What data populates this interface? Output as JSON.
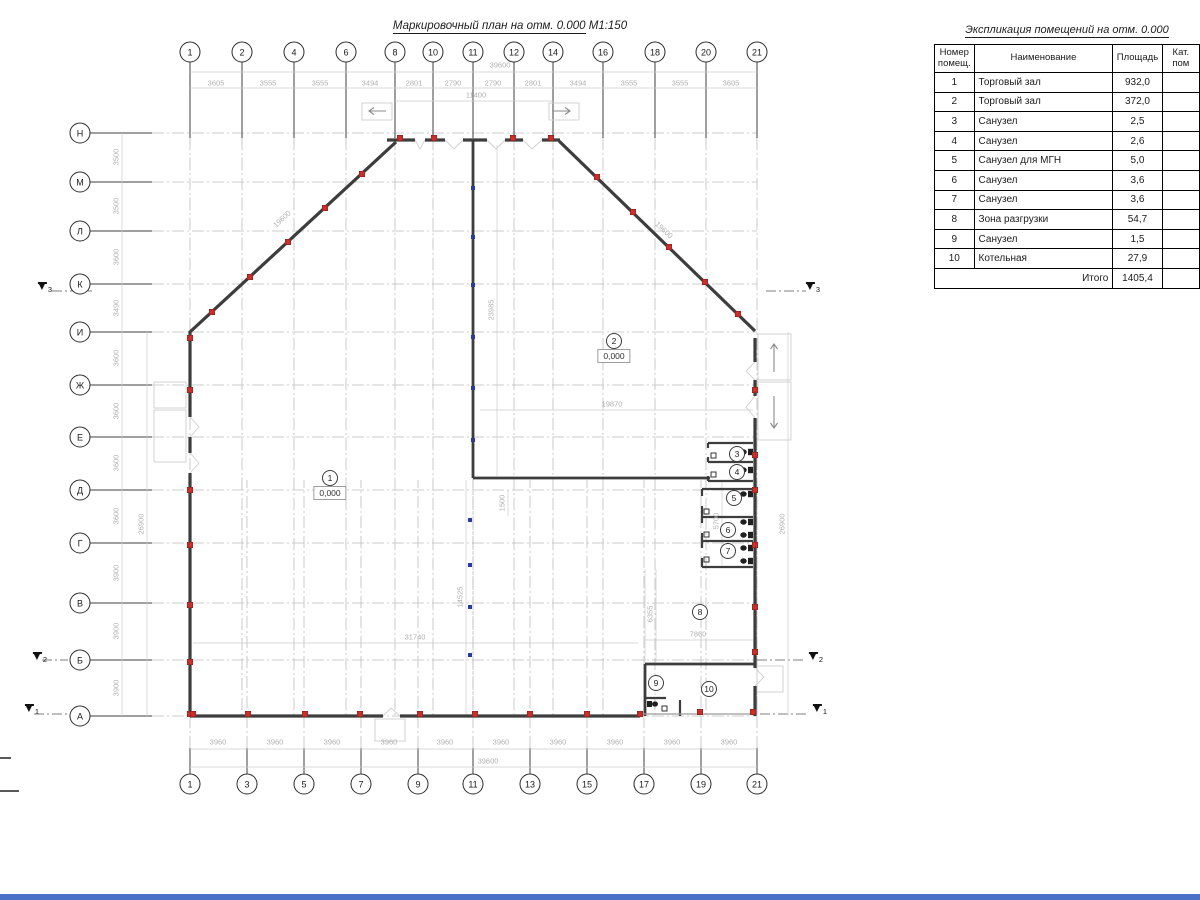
{
  "drawing_title": {
    "text": "Маркировочный план на отм. 0.000",
    "scale": "М1:150"
  },
  "table": {
    "title": "Экспликация помещений на отм. 0.000",
    "headers": {
      "num": "Номер помещ.",
      "name": "Наименование",
      "area": "Площадь",
      "cat": "Кат. пом"
    },
    "rows": [
      {
        "num": "1",
        "name": "Торговый зал",
        "area": "932,0"
      },
      {
        "num": "2",
        "name": "Торговый зал",
        "area": "372,0"
      },
      {
        "num": "3",
        "name": "Санузел",
        "area": "2,5"
      },
      {
        "num": "4",
        "name": "Санузел",
        "area": "2,6"
      },
      {
        "num": "5",
        "name": "Санузел для МГН",
        "area": "5,0"
      },
      {
        "num": "6",
        "name": "Санузел",
        "area": "3,6"
      },
      {
        "num": "7",
        "name": "Санузел",
        "area": "3,6"
      },
      {
        "num": "8",
        "name": "Зона разгрузки",
        "area": "54,7"
      },
      {
        "num": "9",
        "name": "Санузел",
        "area": "1,5"
      },
      {
        "num": "10",
        "name": "Котельная",
        "area": "27,9"
      }
    ],
    "total_label": "Итого",
    "total_value": "1405,4"
  },
  "axes": {
    "top": [
      {
        "label": "1",
        "x": 190
      },
      {
        "label": "2",
        "x": 242
      },
      {
        "label": "4",
        "x": 294
      },
      {
        "label": "6",
        "x": 346
      },
      {
        "label": "8",
        "x": 395
      },
      {
        "label": "10",
        "x": 433
      },
      {
        "label": "11",
        "x": 473
      },
      {
        "label": "12",
        "x": 514
      },
      {
        "label": "14",
        "x": 553
      },
      {
        "label": "16",
        "x": 603
      },
      {
        "label": "18",
        "x": 655
      },
      {
        "label": "20",
        "x": 706
      },
      {
        "label": "21",
        "x": 757
      }
    ],
    "bottom": [
      {
        "label": "1",
        "x": 190
      },
      {
        "label": "3",
        "x": 247
      },
      {
        "label": "5",
        "x": 304
      },
      {
        "label": "7",
        "x": 361
      },
      {
        "label": "9",
        "x": 418
      },
      {
        "label": "11",
        "x": 473
      },
      {
        "label": "13",
        "x": 530
      },
      {
        "label": "15",
        "x": 587
      },
      {
        "label": "17",
        "x": 644
      },
      {
        "label": "19",
        "x": 701
      },
      {
        "label": "21",
        "x": 757
      }
    ],
    "left": [
      {
        "label": "Н",
        "y": 133
      },
      {
        "label": "М",
        "y": 182
      },
      {
        "label": "Л",
        "y": 231
      },
      {
        "label": "К",
        "y": 284
      },
      {
        "label": "И",
        "y": 332
      },
      {
        "label": "Ж",
        "y": 385
      },
      {
        "label": "Е",
        "y": 437
      },
      {
        "label": "Д",
        "y": 490
      },
      {
        "label": "Г",
        "y": 543
      },
      {
        "label": "В",
        "y": 603
      },
      {
        "label": "Б",
        "y": 660
      },
      {
        "label": "А",
        "y": 716
      }
    ]
  },
  "dim_labels": [
    {
      "t": "3605",
      "x": 216,
      "y": 83
    },
    {
      "t": "3555",
      "x": 268,
      "y": 83
    },
    {
      "t": "3555",
      "x": 320,
      "y": 83
    },
    {
      "t": "3494",
      "x": 370,
      "y": 83
    },
    {
      "t": "2801",
      "x": 414,
      "y": 83
    },
    {
      "t": "2790",
      "x": 453,
      "y": 83
    },
    {
      "t": "2790",
      "x": 493,
      "y": 83
    },
    {
      "t": "2801",
      "x": 533,
      "y": 83
    },
    {
      "t": "3494",
      "x": 578,
      "y": 83
    },
    {
      "t": "3555",
      "x": 629,
      "y": 83
    },
    {
      "t": "3555",
      "x": 680,
      "y": 83
    },
    {
      "t": "3605",
      "x": 731,
      "y": 83
    },
    {
      "t": "39600",
      "x": 500,
      "y": 65
    },
    {
      "t": "11400",
      "x": 476,
      "y": 95
    },
    {
      "t": "3960",
      "x": 218,
      "y": 742
    },
    {
      "t": "3960",
      "x": 275,
      "y": 742
    },
    {
      "t": "3960",
      "x": 332,
      "y": 742
    },
    {
      "t": "3960",
      "x": 389,
      "y": 742
    },
    {
      "t": "3960",
      "x": 445,
      "y": 742
    },
    {
      "t": "3960",
      "x": 501,
      "y": 742
    },
    {
      "t": "3960",
      "x": 558,
      "y": 742
    },
    {
      "t": "3960",
      "x": 615,
      "y": 742
    },
    {
      "t": "3960",
      "x": 672,
      "y": 742
    },
    {
      "t": "3960",
      "x": 729,
      "y": 742
    },
    {
      "t": "39600",
      "x": 488,
      "y": 761
    },
    {
      "t": "3500",
      "x": 116,
      "y": 157,
      "r": -90
    },
    {
      "t": "3500",
      "x": 116,
      "y": 206,
      "r": -90
    },
    {
      "t": "3600",
      "x": 116,
      "y": 257,
      "r": -90
    },
    {
      "t": "3490",
      "x": 116,
      "y": 308,
      "r": -90
    },
    {
      "t": "3600",
      "x": 116,
      "y": 358,
      "r": -90
    },
    {
      "t": "3600",
      "x": 116,
      "y": 411,
      "r": -90
    },
    {
      "t": "3600",
      "x": 116,
      "y": 463,
      "r": -90
    },
    {
      "t": "3600",
      "x": 116,
      "y": 516,
      "r": -90
    },
    {
      "t": "3900",
      "x": 116,
      "y": 573,
      "r": -90
    },
    {
      "t": "3900",
      "x": 116,
      "y": 631,
      "r": -90
    },
    {
      "t": "3900",
      "x": 116,
      "y": 688,
      "r": -90
    },
    {
      "t": "26900",
      "x": 141,
      "y": 524,
      "r": -90
    },
    {
      "t": "26900",
      "x": 782,
      "y": 524,
      "r": -90
    },
    {
      "t": "19870",
      "x": 612,
      "y": 404
    },
    {
      "t": "31740",
      "x": 415,
      "y": 637
    },
    {
      "t": "7860",
      "x": 698,
      "y": 634
    },
    {
      "t": "6355",
      "x": 650,
      "y": 614,
      "r": -90
    },
    {
      "t": "5700",
      "x": 716,
      "y": 521,
      "r": -90
    },
    {
      "t": "14525",
      "x": 460,
      "y": 597,
      "r": -90
    },
    {
      "t": "23985",
      "x": 491,
      "y": 310,
      "r": -90
    },
    {
      "t": "1500",
      "x": 502,
      "y": 503,
      "r": -90
    },
    {
      "t": "19600",
      "x": 282,
      "y": 219,
      "r": -43
    },
    {
      "t": "19600",
      "x": 664,
      "y": 230,
      "r": 43
    }
  ],
  "rooms": [
    {
      "num": "1",
      "x": 330,
      "y": 478,
      "level": "0,000"
    },
    {
      "num": "2",
      "x": 614,
      "y": 341,
      "level": "0,000"
    },
    {
      "num": "3",
      "x": 737,
      "y": 454
    },
    {
      "num": "4",
      "x": 737,
      "y": 472
    },
    {
      "num": "5",
      "x": 734,
      "y": 498
    },
    {
      "num": "6",
      "x": 728,
      "y": 530
    },
    {
      "num": "7",
      "x": 728,
      "y": 551
    },
    {
      "num": "8",
      "x": 700,
      "y": 612
    },
    {
      "num": "9",
      "x": 656,
      "y": 683
    },
    {
      "num": "10",
      "x": 709,
      "y": 689
    }
  ],
  "section_marks": [
    {
      "label": "3",
      "x": 45,
      "y": 288
    },
    {
      "label": "3",
      "x": 813,
      "y": 288
    },
    {
      "label": "2",
      "x": 40,
      "y": 658
    },
    {
      "label": "2",
      "x": 816,
      "y": 658
    },
    {
      "label": "1",
      "x": 32,
      "y": 710
    },
    {
      "label": "1",
      "x": 820,
      "y": 710
    }
  ],
  "markers": {
    "red": [
      [
        212,
        312
      ],
      [
        250,
        277
      ],
      [
        288,
        242
      ],
      [
        325,
        208
      ],
      [
        362,
        174
      ],
      [
        400,
        138
      ],
      [
        434,
        138
      ],
      [
        513,
        138
      ],
      [
        551,
        138
      ],
      [
        597,
        177
      ],
      [
        633,
        212
      ],
      [
        669,
        247
      ],
      [
        705,
        282
      ],
      [
        738,
        314
      ],
      [
        190,
        338
      ],
      [
        190,
        390
      ],
      [
        190,
        490
      ],
      [
        190,
        545
      ],
      [
        190,
        605
      ],
      [
        190,
        662
      ],
      [
        190,
        714
      ],
      [
        193,
        714
      ],
      [
        248,
        714
      ],
      [
        305,
        714
      ],
      [
        360,
        714
      ],
      [
        420,
        714
      ],
      [
        475,
        714
      ],
      [
        530,
        714
      ],
      [
        587,
        714
      ],
      [
        640,
        714
      ],
      [
        700,
        712
      ],
      [
        753,
        712
      ],
      [
        755,
        390
      ],
      [
        755,
        455
      ],
      [
        755,
        490
      ],
      [
        755,
        545
      ],
      [
        755,
        607
      ],
      [
        755,
        652
      ]
    ],
    "blue": [
      [
        473,
        188
      ],
      [
        473,
        237
      ],
      [
        473,
        285
      ],
      [
        473,
        337
      ],
      [
        473,
        388
      ],
      [
        473,
        440
      ],
      [
        470,
        520
      ],
      [
        470,
        565
      ],
      [
        470,
        607
      ],
      [
        470,
        655
      ]
    ]
  },
  "colors": {
    "wall": "#3d3d3d",
    "marker_red": "#c9302c",
    "marker_column_blue": "#2b3a9e",
    "grid_line": "#6f6f6f",
    "dimension_text": "#b0b0b0",
    "frame_accent_blue": "#4a70c8"
  }
}
